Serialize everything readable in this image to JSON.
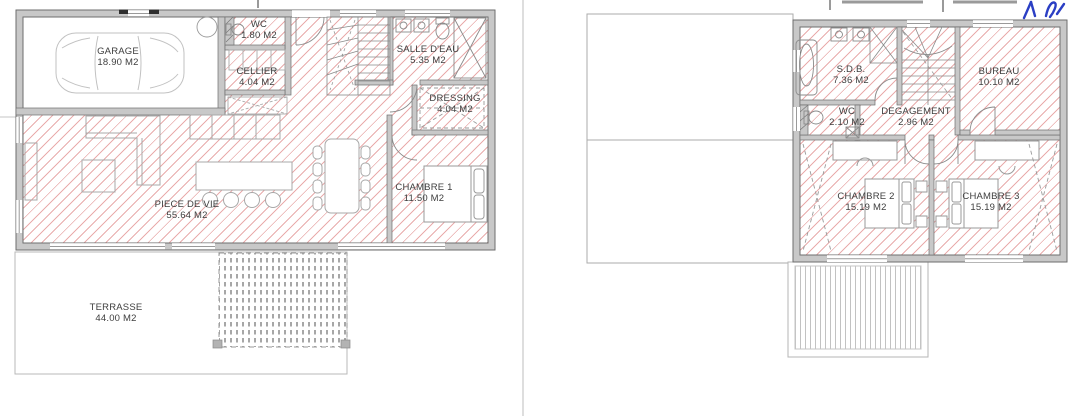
{
  "document_kind": "architect-floor-plan-scan",
  "colors": {
    "paper": "#ffffff",
    "hatch_red": "#e9acac",
    "wall_gray": "#c8c8c8",
    "wall_edge": "#6e6e6e",
    "furniture_gray": "#a8a8a8",
    "label_text": "#3e3e3e",
    "pen_ink_blue": "#2b3fc4",
    "page_fold": "#dedede"
  },
  "ground_floor": {
    "rooms": [
      {
        "name": "GARAGE",
        "area": "18.90 M2"
      },
      {
        "name": "WC",
        "area": "1.80 M2"
      },
      {
        "name": "CELLIER",
        "area": "4.04 M2"
      },
      {
        "name": "SALLE D'EAU",
        "area": "5.35 M2"
      },
      {
        "name": "DRESSING",
        "area": "4.04 M2"
      },
      {
        "name": "CHAMBRE 1",
        "area": "11.50 M2"
      },
      {
        "name": "PIECE DE VIE",
        "area": "55.64 M2"
      },
      {
        "name": "TERRASSE",
        "area": "44.00 M2"
      }
    ]
  },
  "first_floor": {
    "rooms": [
      {
        "name": "S.D.B.",
        "area": "7.36 M2"
      },
      {
        "name": "WC",
        "area": "2.10 M2"
      },
      {
        "name": "DEGAGEMENT",
        "area": "2.96 M2"
      },
      {
        "name": "BUREAU",
        "area": "10.10 M2"
      },
      {
        "name": "CHAMBRE 2",
        "area": "15.19 M2"
      },
      {
        "name": "CHAMBRE 3",
        "area": "15.19 M2"
      }
    ]
  }
}
